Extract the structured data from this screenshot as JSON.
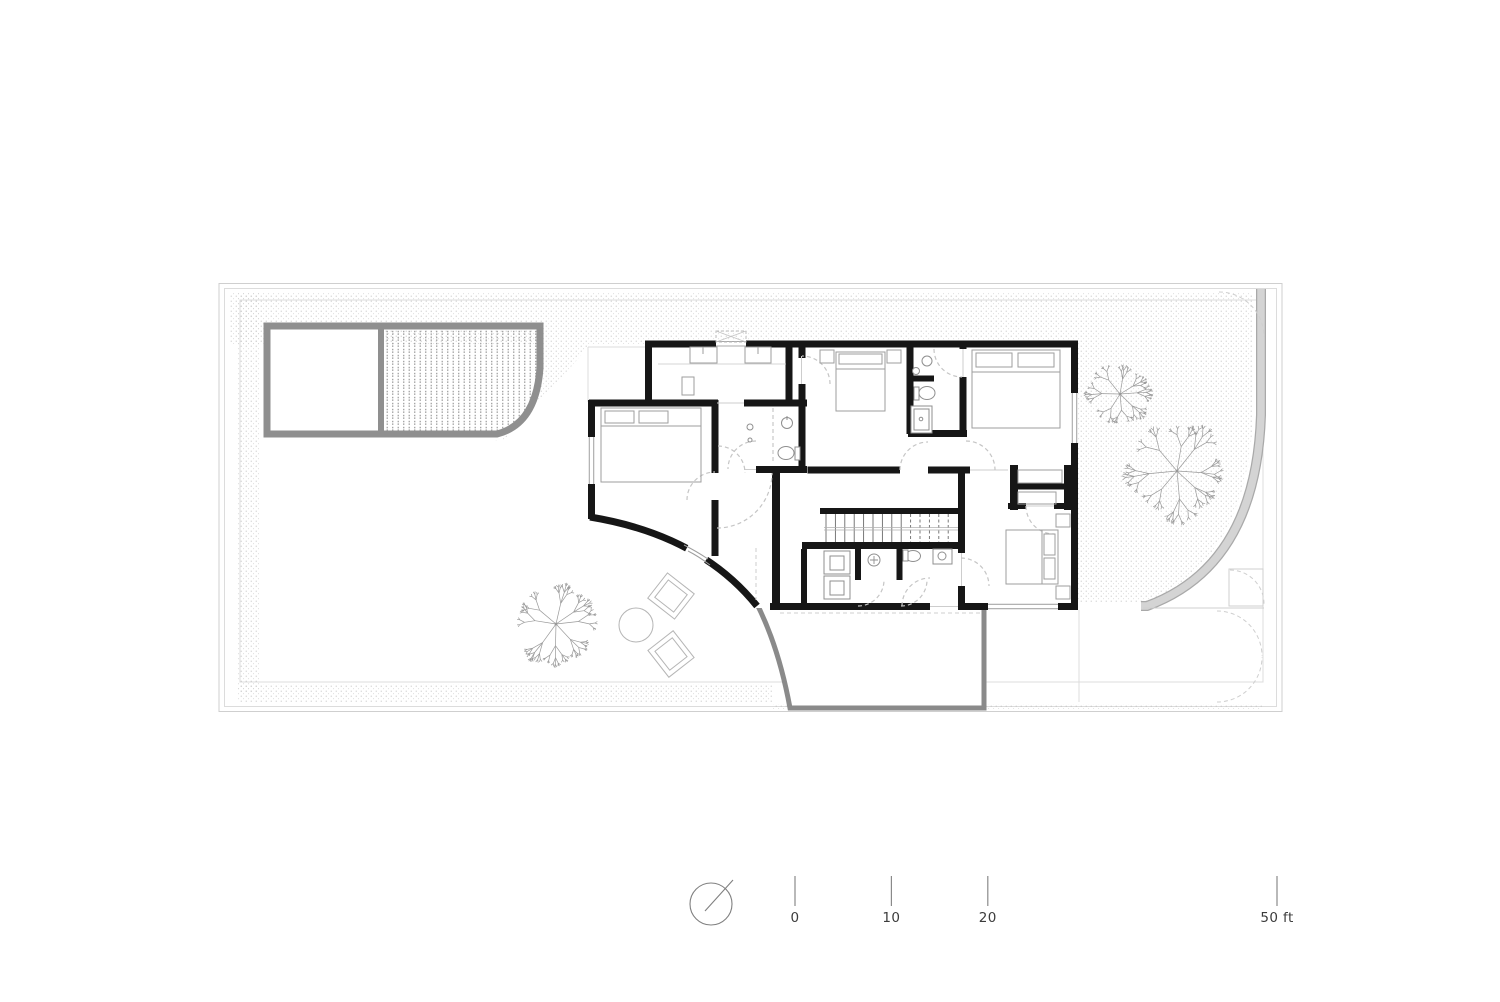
{
  "drawing": {
    "kind": "architectural-floor-plan",
    "floor": "upper-floor plan with four bedrooms, pool, garden and terrace"
  },
  "colors": {
    "wall": "#161616",
    "poolborder": "#8f8f8f",
    "terrace": "#8a8a8a",
    "pathfill": "#d4d4d4",
    "pathedge": "#a9a9a9",
    "stipple": "#bdbdbd",
    "pooldot": "#9d9d9d",
    "furn": "#9e9e9e",
    "fix": "#8f8f8f",
    "door": "#c5c5c5",
    "gate": "#cfcfcf",
    "bound": "#cfcfcf",
    "hair": "#dcdcdc",
    "tree": "#8f8f8f",
    "text": "#3c3c3c",
    "tick": "#8a8a8a"
  },
  "scale_bar": {
    "origin_x": 795,
    "px_per_ft": 9.64,
    "tick_top": 876,
    "tick_height": 30,
    "label_y": 922,
    "ticks": [
      {
        "label": "0",
        "ft": 0
      },
      {
        "label": "10",
        "ft": 10
      },
      {
        "label": "20",
        "ft": 20
      },
      {
        "label": "50 ft",
        "ft": 50
      }
    ]
  },
  "north_indicator": {
    "cx": 711,
    "cy": 904,
    "r": 21,
    "line": [
      705,
      911,
      733,
      880
    ]
  },
  "site": {
    "trees": [
      {
        "cx": 556,
        "cy": 624,
        "r": 40,
        "seed": 11
      },
      {
        "cx": 1120,
        "cy": 394,
        "r": 29,
        "seed": 23
      },
      {
        "cx": 1177,
        "cy": 471,
        "r": 45,
        "seed": 37
      }
    ],
    "loungers": [
      {
        "cx": 671,
        "cy": 596,
        "rot": 38
      },
      {
        "cx": 671,
        "cy": 654,
        "rot": 52
      }
    ],
    "table": {
      "cx": 636,
      "cy": 625,
      "r": 17
    }
  }
}
